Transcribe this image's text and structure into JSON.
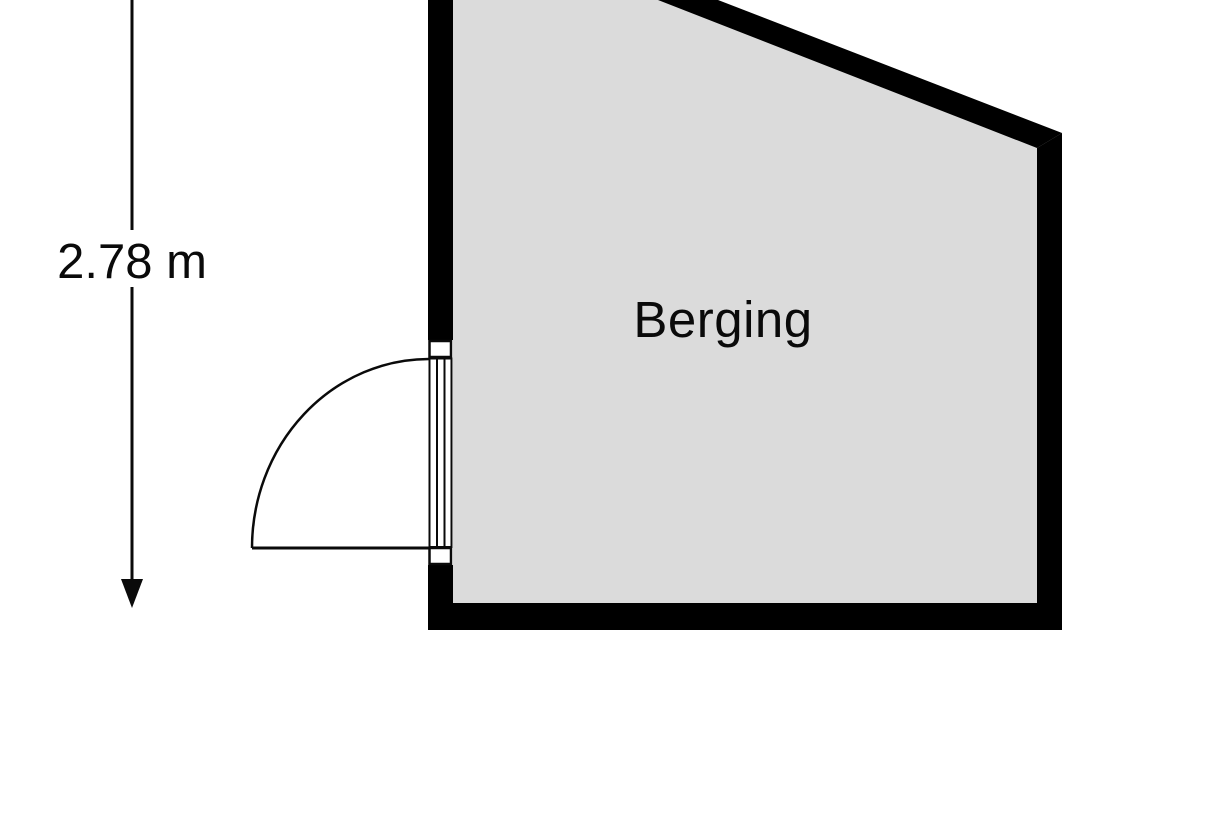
{
  "floorplan": {
    "room": {
      "label": "Berging",
      "floor_color": "#dbdbdb"
    },
    "dimension": {
      "label": "2.78 m",
      "orientation": "vertical"
    },
    "colors": {
      "wall": "#000000",
      "background": "#ffffff",
      "line": "#0a0a0a"
    }
  }
}
